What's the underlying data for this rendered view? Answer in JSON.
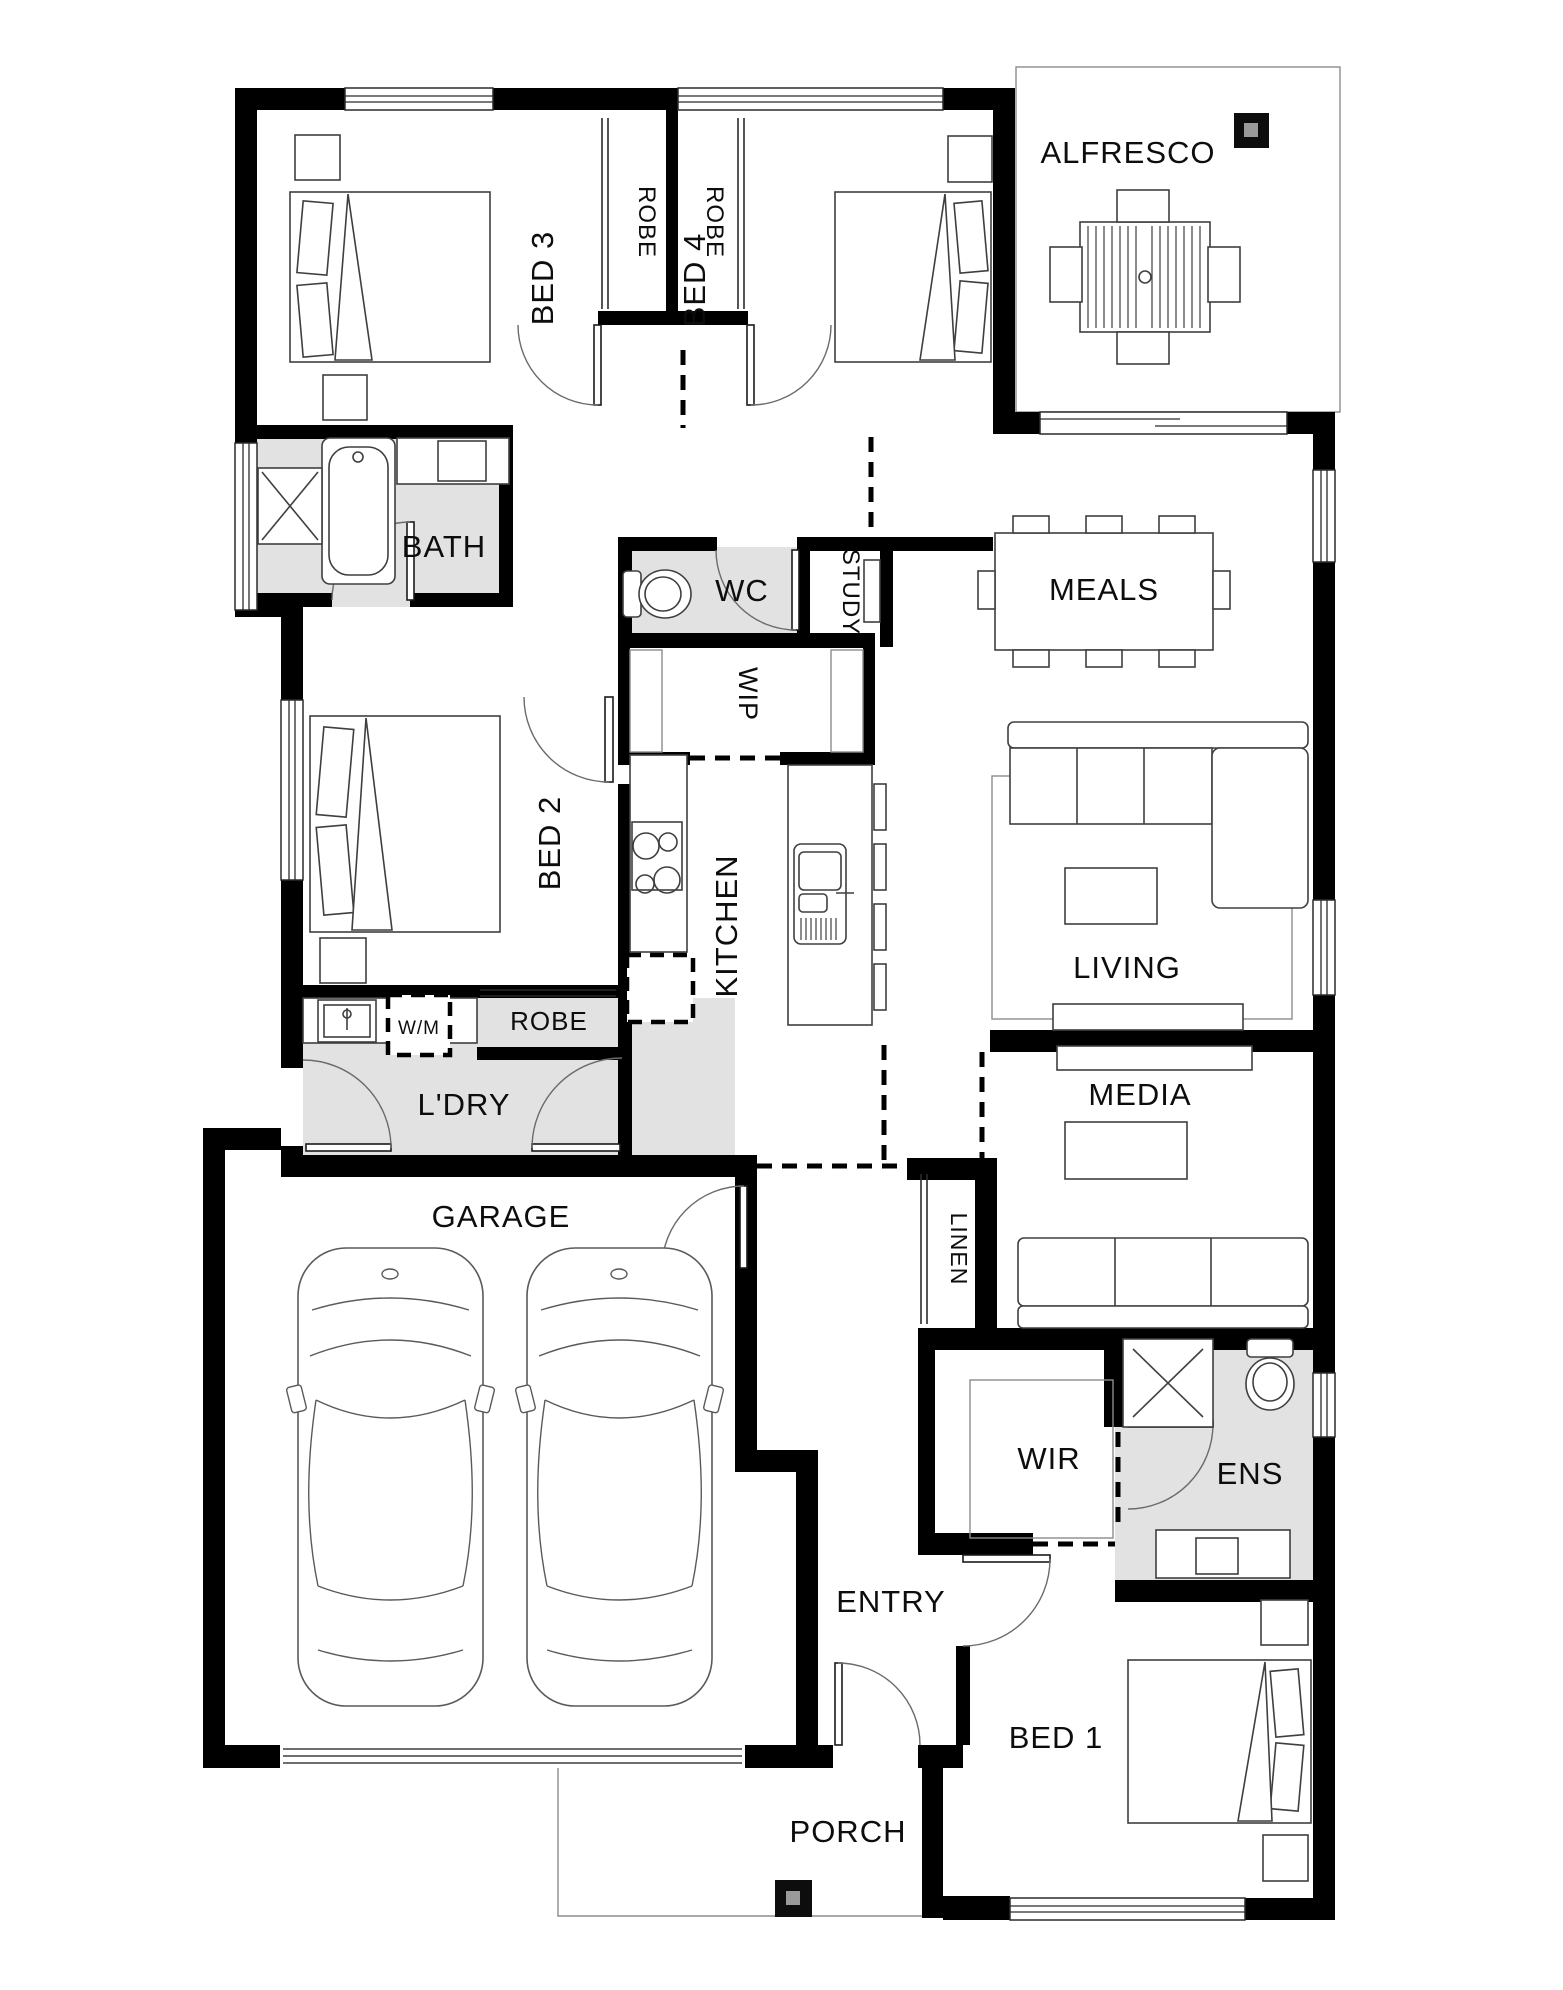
{
  "plan": {
    "colors": {
      "wall": "#000000",
      "wet_area_floor": "#e2e2e2",
      "background": "#ffffff"
    },
    "rooms": {
      "alfresco": "ALFRESCO",
      "bed3": "BED 3",
      "robe_bed3": "ROBE",
      "robe_bed4": "ROBE",
      "bed4": "BED 4",
      "bath": "BATH",
      "wc": "WC",
      "study": "STUDY",
      "meals": "MEALS",
      "wip": "WIP",
      "bed2": "BED 2",
      "kitchen": "KITCHEN",
      "living": "LIVING",
      "laundry_robe": "ROBE",
      "washing_machine": "W/M",
      "laundry": "L'DRY",
      "media": "MEDIA",
      "garage": "GARAGE",
      "linen": "LINEN",
      "wir": "WIR",
      "ens": "ENS",
      "entry": "ENTRY",
      "bed1": "BED 1",
      "porch": "PORCH"
    }
  }
}
